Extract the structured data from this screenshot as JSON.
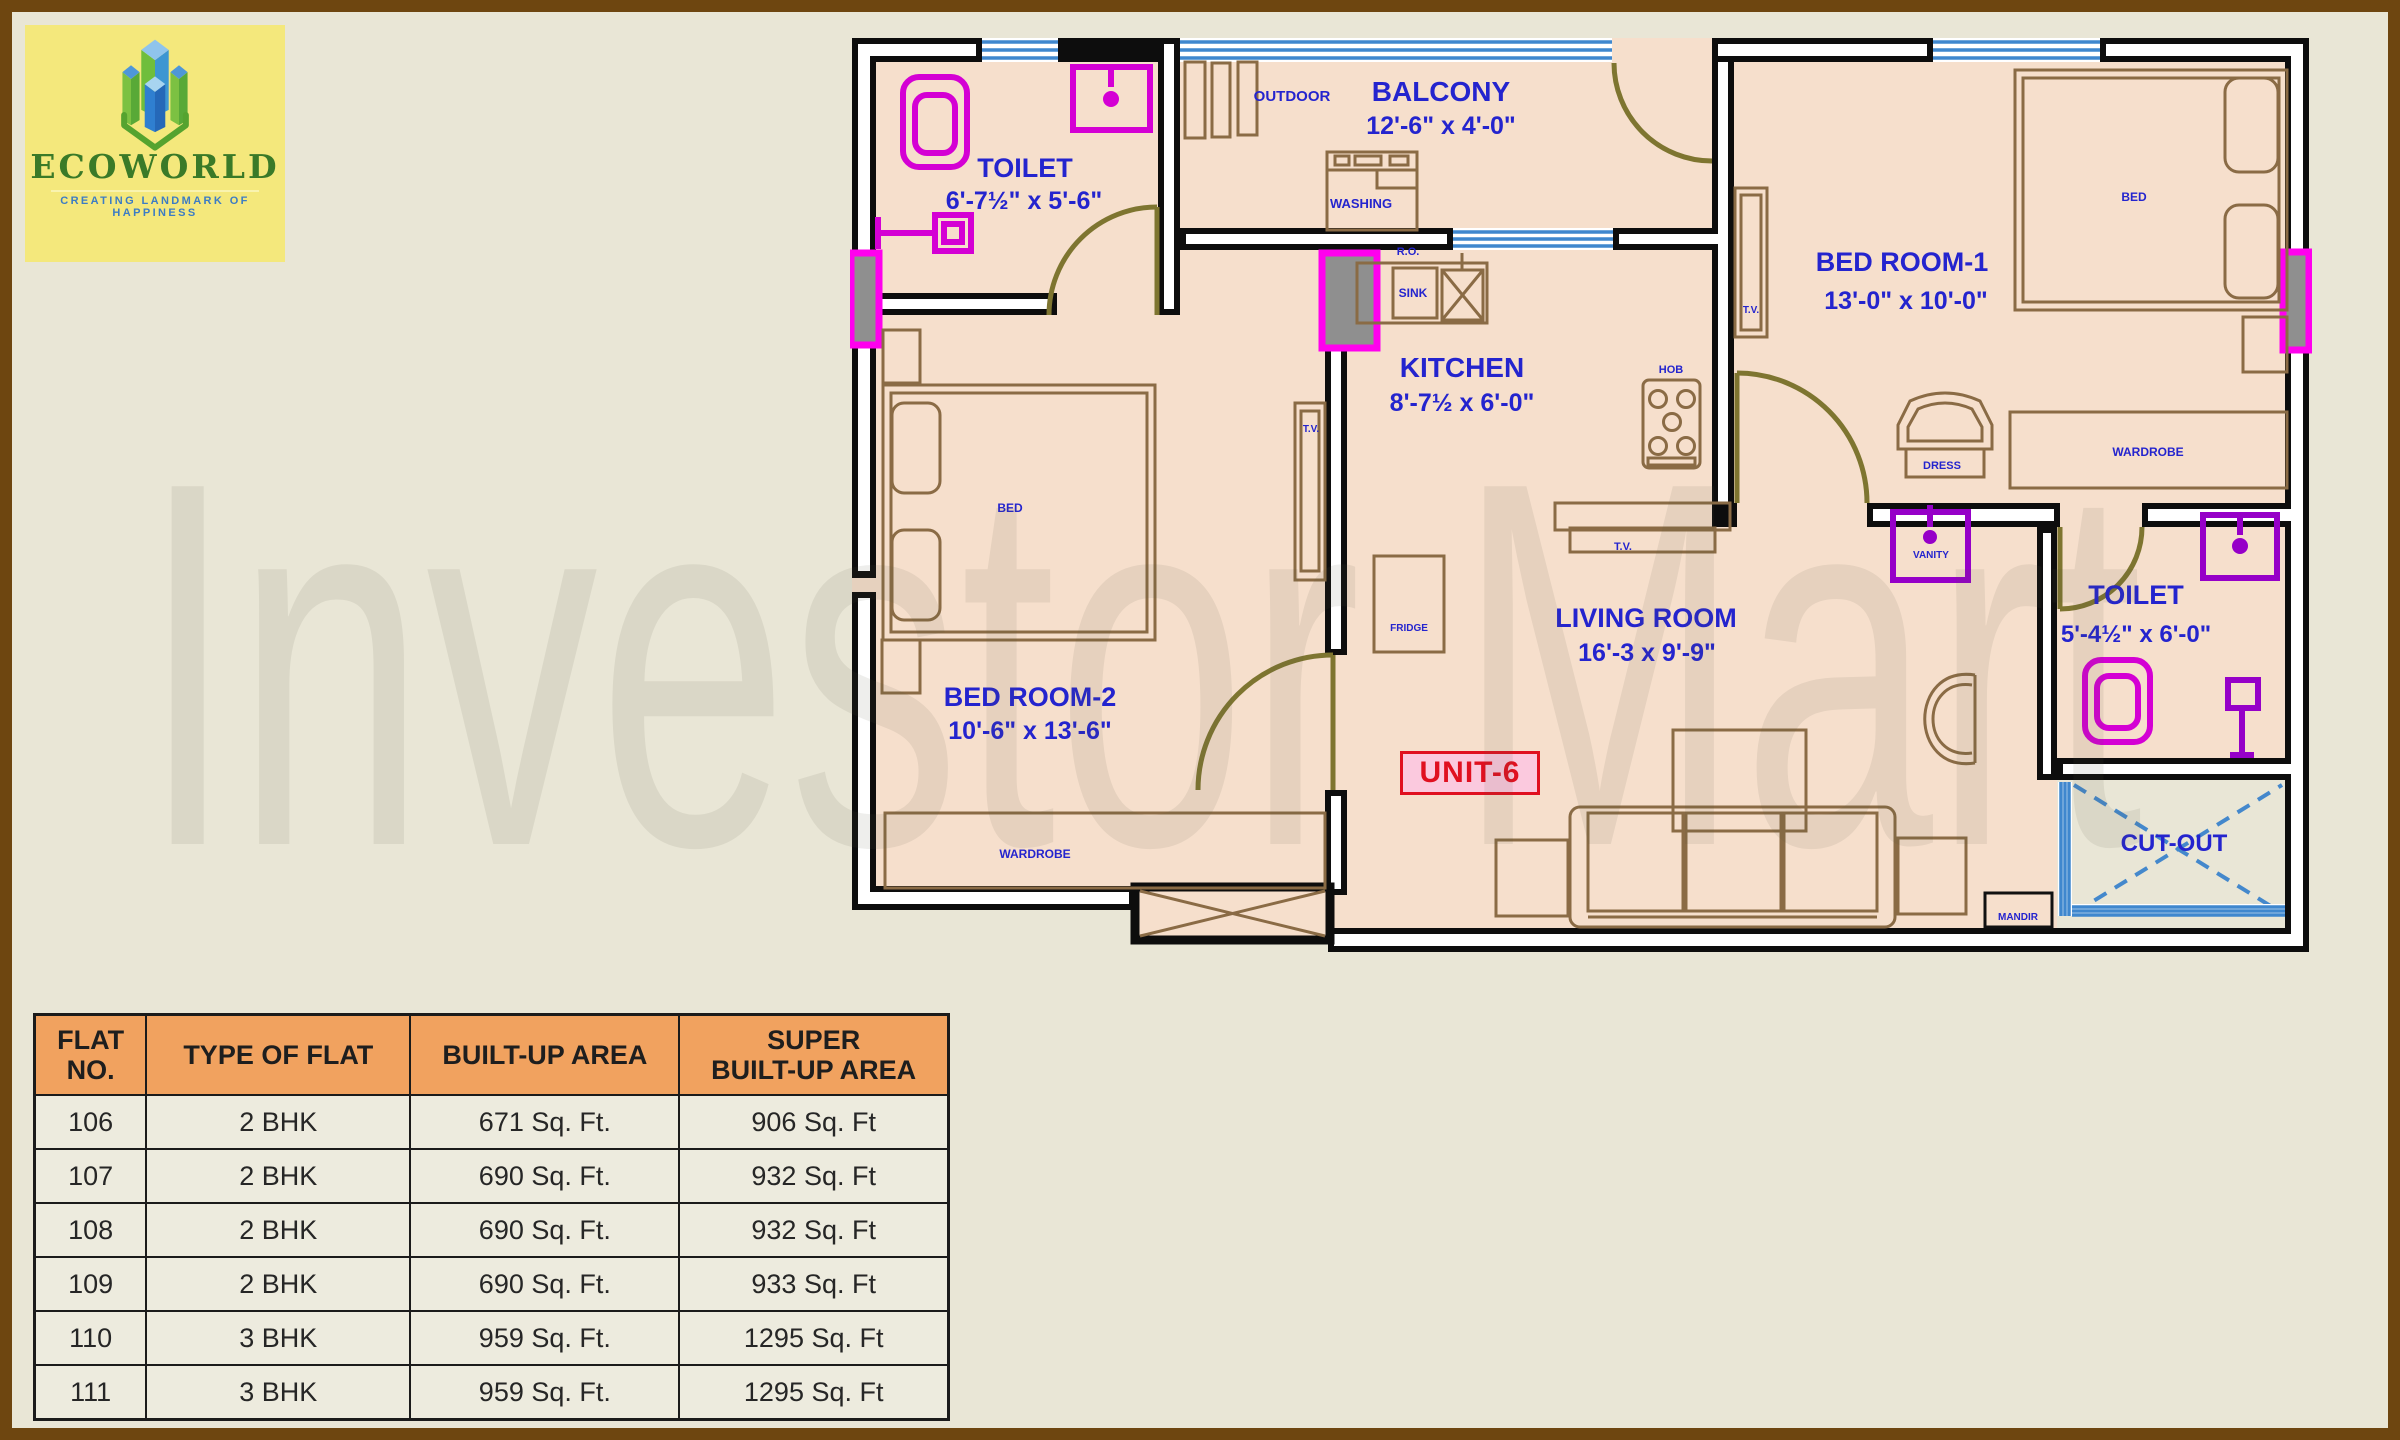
{
  "logo": {
    "name": "ECOWORLD",
    "tagline": "CREATING LANDMARK OF HAPPINESS"
  },
  "watermark": "Investor Mart",
  "unit_label": "UNIT-6",
  "colors": {
    "page_background": "#E9E6D6",
    "frame_brown": "#6E4610",
    "floor_peach": "#F6DFCC",
    "wall_black": "#0D0D0D",
    "window_blue": "#3F87CE",
    "label_blue": "#2424CE",
    "fixture_magenta": "#D400D4",
    "fixture_purple": "#9600C8",
    "door_olive": "#7E7530",
    "furniture_brown": "#8A6B45",
    "unit_red": "#E01020",
    "unit_pink": "#FBC9DE",
    "table_header_orange": "#F1A25F",
    "table_row_cream": "#EDEBDE",
    "logo_yellow": "#F4E87C",
    "logo_green": "#3A7A28",
    "logo_tagline_blue": "#3C7CC4"
  },
  "floor_plan": {
    "labels": [
      {
        "name": "toilet1-name",
        "text": "TOILET",
        "x": 175,
        "y": 152,
        "size": 27
      },
      {
        "name": "toilet1-dims",
        "text": "6'-7½\" x 5'-6\"",
        "x": 174,
        "y": 184,
        "size": 25
      },
      {
        "name": "outdoor-label",
        "text": "OUTDOOR",
        "x": 442,
        "y": 76,
        "size": 15
      },
      {
        "name": "balcony-name",
        "text": "BALCONY",
        "x": 591,
        "y": 76,
        "size": 28
      },
      {
        "name": "balcony-dims",
        "text": "12'-6\" x 4'-0\"",
        "x": 591,
        "y": 109,
        "size": 25
      },
      {
        "name": "washing-label",
        "text": "WASHING",
        "x": 511,
        "y": 183,
        "size": 13
      },
      {
        "name": "ro-label",
        "text": "R.O.",
        "x": 558,
        "y": 230,
        "size": 11
      },
      {
        "name": "sink-label",
        "text": "SINK",
        "x": 563,
        "y": 272,
        "size": 12
      },
      {
        "name": "kitchen-name",
        "text": "KITCHEN",
        "x": 612,
        "y": 352,
        "size": 28
      },
      {
        "name": "kitchen-dims",
        "text": "8'-7½ x 6'-0\"",
        "x": 612,
        "y": 386,
        "size": 25
      },
      {
        "name": "hob-label",
        "text": "HOB",
        "x": 821,
        "y": 348,
        "size": 11
      },
      {
        "name": "tv-passage-label",
        "text": "T.V.",
        "x": 901,
        "y": 288,
        "size": 10
      },
      {
        "name": "bedroom1-name",
        "text": "BED ROOM-1",
        "x": 1052,
        "y": 246,
        "size": 27
      },
      {
        "name": "bedroom1-dims",
        "text": "13'-0\" x 10'-0\"",
        "x": 1056,
        "y": 284,
        "size": 25
      },
      {
        "name": "bed1-label",
        "text": "BED",
        "x": 1284,
        "y": 176,
        "size": 12
      },
      {
        "name": "tv-bed2-label",
        "text": "T.V.",
        "x": 461,
        "y": 407,
        "size": 10
      },
      {
        "name": "bed2-label",
        "text": "BED",
        "x": 160,
        "y": 487,
        "size": 12
      },
      {
        "name": "bedroom2-name",
        "text": "BED ROOM-2",
        "x": 180,
        "y": 681,
        "size": 27
      },
      {
        "name": "bedroom2-dims",
        "text": "10'-6\" x 13'-6\"",
        "x": 180,
        "y": 714,
        "size": 25
      },
      {
        "name": "wardrobe-bed2-label",
        "text": "WARDROBE",
        "x": 185,
        "y": 833,
        "size": 12
      },
      {
        "name": "wardrobe-bed1-label",
        "text": "WARDROBE",
        "x": 1298,
        "y": 431,
        "size": 12
      },
      {
        "name": "dress-label",
        "text": "DRESS",
        "x": 1092,
        "y": 444,
        "size": 11
      },
      {
        "name": "vanity-label",
        "text": "VANITY",
        "x": 1081,
        "y": 533,
        "size": 10
      },
      {
        "name": "living-name",
        "text": "LIVING ROOM",
        "x": 796,
        "y": 602,
        "size": 27
      },
      {
        "name": "living-dims",
        "text": "16'-3 x 9'-9\"",
        "x": 797,
        "y": 636,
        "size": 25
      },
      {
        "name": "fridge-label",
        "text": "FRIDGE",
        "x": 559,
        "y": 606,
        "size": 10
      },
      {
        "name": "tv-kitchen-label",
        "text": "T.V.",
        "x": 773,
        "y": 525,
        "size": 11
      },
      {
        "name": "toilet2-name",
        "text": "TOILET",
        "x": 1286,
        "y": 579,
        "size": 27
      },
      {
        "name": "toilet2-dims",
        "text": "5'-4½\" x 6'-0\"",
        "x": 1286,
        "y": 617,
        "size": 24
      },
      {
        "name": "cutout-label",
        "text": "CUT-OUT",
        "x": 1324,
        "y": 826,
        "size": 24
      },
      {
        "name": "mandir-label",
        "text": "MANDIR",
        "x": 1168,
        "y": 895,
        "size": 10
      }
    ]
  },
  "table": {
    "columns": [
      "FLAT\nNO.",
      "TYPE OF FLAT",
      "BUILT-UP AREA",
      "SUPER\nBUILT-UP AREA"
    ],
    "rows": [
      [
        "106",
        "2 BHK",
        "671  Sq. Ft.",
        "906  Sq. Ft"
      ],
      [
        "107",
        "2 BHK",
        "690  Sq. Ft.",
        "932  Sq. Ft"
      ],
      [
        "108",
        "2 BHK",
        "690  Sq. Ft.",
        "932  Sq. Ft"
      ],
      [
        "109",
        "2 BHK",
        "690  Sq. Ft.",
        "933  Sq. Ft"
      ],
      [
        "110",
        "3 BHK",
        "959 Sq. Ft.",
        "1295  Sq. Ft"
      ],
      [
        "111",
        "3 BHK",
        "959 Sq. Ft.",
        "1295  Sq. Ft"
      ]
    ]
  }
}
